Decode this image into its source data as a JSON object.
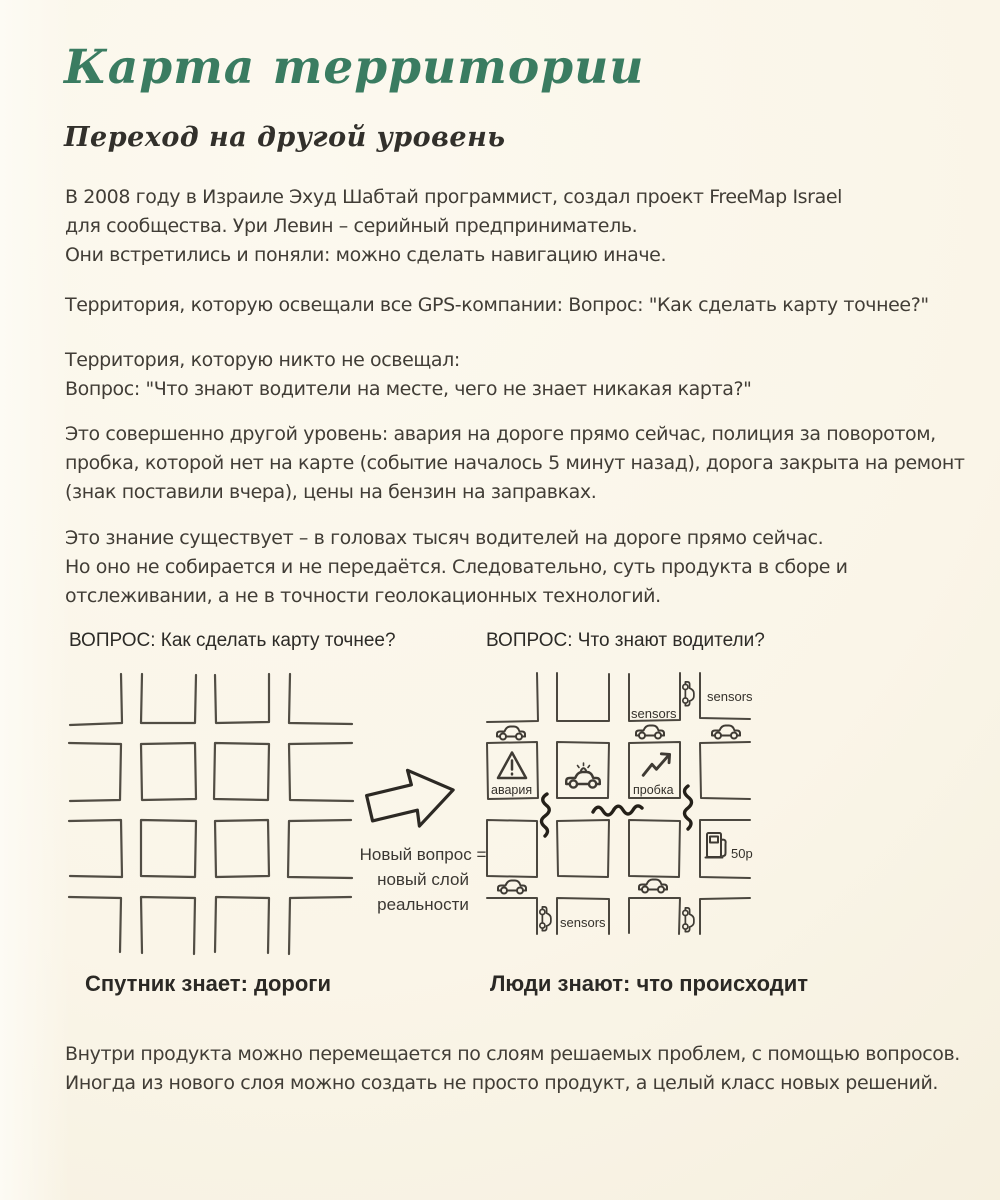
{
  "colors": {
    "background": "#faf5e8",
    "title_green": "#3a7c61",
    "body_text": "#413d36",
    "ink": "#4b473f"
  },
  "header": {
    "title": "Карта территории",
    "subtitle": "Переход на другой уровень"
  },
  "paragraphs": {
    "p1": [
      "В 2008 году в Израиле Эхуд Шабтай программист, создал проект FreeMap Israel",
      "для сообщества. Ури Левин – серийный предприниматель.",
      "Они встретились и поняли: можно сделать навигацию иначе."
    ],
    "p2": [
      "Территория, которую освещали все GPS-компании: Вопрос: \"Как сделать карту точнее?\""
    ],
    "p3": [
      "Территория, которую никто не освещал:",
      "Вопрос: \"Что знают водители на месте, чего не знает никакая карта?\""
    ],
    "p4": [
      "Это совершенно другой уровень: авария на дороге прямо сейчас, полиция за поворотом,",
      "пробка, которой нет на карте (событие началось 5 минут назад), дорога закрыта на ремонт",
      "(знак поставили вчера), цены на бензин на заправках."
    ],
    "p5": [
      "Это знание существует – в головах тысяч водителей на дороге прямо сейчас.",
      "Но оно не собирается и не передаётся. Следовательно, суть продукта в сборе и",
      "отслеживании, а не в точности геолокационных технологий."
    ],
    "p6": [
      "Внутри продукта можно перемещается по слоям решаемых проблем, с помощью вопросов.",
      "Иногда из нового слоя можно создать не просто продукт,  а целый класс новых решений."
    ]
  },
  "diagram_left": {
    "question": "ВОПРОС: Как сделать карту точнее?",
    "caption": "Спутник знает: дороги"
  },
  "diagram_right": {
    "question": "ВОПРОС: Что знают водители?",
    "caption": "Люди знают: что происходит",
    "label_accident": "авария",
    "label_jam": "пробка",
    "label_sensors_top": "sensors",
    "label_sensors_mid": "sensors",
    "label_sensors_bottom": "sensors",
    "label_fuel": "50p"
  },
  "arrow": {
    "caption_lines": [
      "Новый вопрос =",
      "новый слой",
      "реальности"
    ]
  }
}
